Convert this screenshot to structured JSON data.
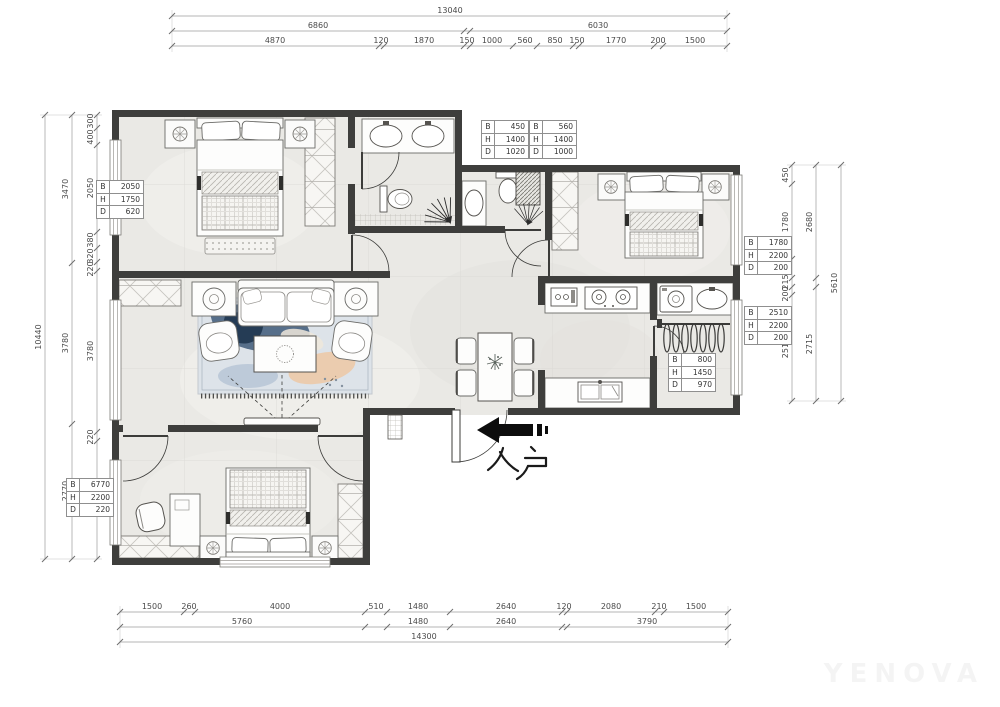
{
  "entry": {
    "label": "入户"
  },
  "watermark": "YENOVA",
  "bhd_labels": [
    "B",
    "H",
    "D"
  ],
  "annotations": [
    {
      "B": "2050",
      "H": "1750",
      "D": "620"
    },
    {
      "B": "450",
      "H": "1400",
      "D": "1020"
    },
    {
      "B": "560",
      "H": "1400",
      "D": "1000"
    },
    {
      "B": "1780",
      "H": "2200",
      "D": "200"
    },
    {
      "B": "2510",
      "H": "2200",
      "D": "200"
    },
    {
      "B": "800",
      "H": "1450",
      "D": "970"
    },
    {
      "B": "6770",
      "H": "2200",
      "D": "220"
    }
  ],
  "dims": {
    "top": {
      "total": "13040",
      "mid": [
        "6860",
        "6030"
      ],
      "inner": [
        "4870",
        "120",
        "1870",
        "150",
        "1000",
        "560",
        "850",
        "150",
        "1770",
        "200",
        "1500"
      ]
    },
    "bottom": {
      "inner": [
        "1500",
        "260",
        "4000",
        "510",
        "1480",
        "2640",
        "120",
        "2080",
        "210",
        "1500"
      ],
      "mid": [
        "5760",
        "1480",
        "2640",
        "3790"
      ],
      "total": "14300"
    },
    "left": {
      "total": "10440",
      "mid": [
        "3470",
        "3780",
        "2770"
      ],
      "inner": [
        "300",
        "400",
        "2050",
        "380",
        "320",
        "220",
        "3780",
        "220",
        "2770"
      ]
    },
    "right": {
      "inner": [
        "450",
        "1780",
        "450",
        "215",
        "200",
        "2510"
      ],
      "mid": [
        "2680",
        "2715"
      ],
      "total": "5610"
    }
  }
}
